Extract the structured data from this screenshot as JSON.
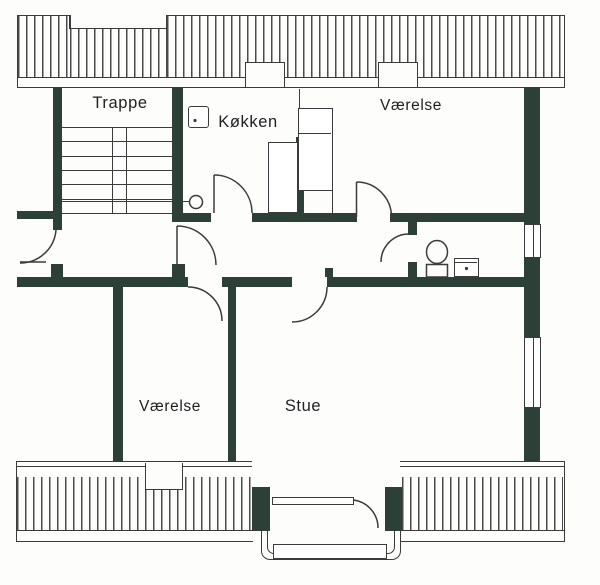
{
  "title": "Apartment floor plan",
  "rooms": {
    "stairwell": "Trappe",
    "kitchen": "Køkken",
    "bedroom_top": "Værelse",
    "bedroom_bottom": "Værelse",
    "living_room": "Stue"
  },
  "fixtures": {
    "toilet": "toilet",
    "sink": "sink",
    "kitchen_sink": "kitchen-sink",
    "balcony": "balcony",
    "stairs": "stairs"
  },
  "colors": {
    "wall": "#2d4038",
    "line": "#3b3b3b",
    "hatch": "#4a4a4a",
    "paper": "#fdfdfc",
    "text": "#1f1f1f"
  }
}
